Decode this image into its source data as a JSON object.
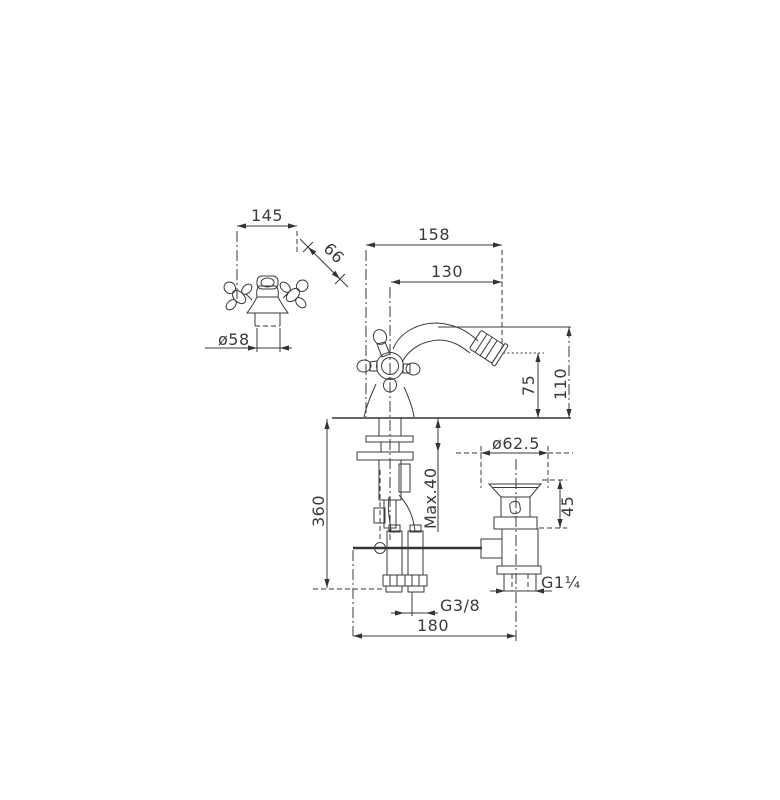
{
  "drawing": {
    "labels": {
      "top_width": "145",
      "spout_diagonal": "66",
      "base_diameter": "ø58",
      "total_reach": "158",
      "spout_reach": "130",
      "outlet_height": "75",
      "total_height": "110",
      "max_deck_thickness": "Max.40",
      "hose_length": "360",
      "waste_flange_diameter": "ø62.5",
      "waste_upper_height": "45",
      "waste_outlet_thread": "G1¼",
      "supply_thread": "G3/8",
      "centre_distance": "180"
    },
    "style": {
      "line_color": "#3a3a3a",
      "background": "#ffffff"
    }
  }
}
